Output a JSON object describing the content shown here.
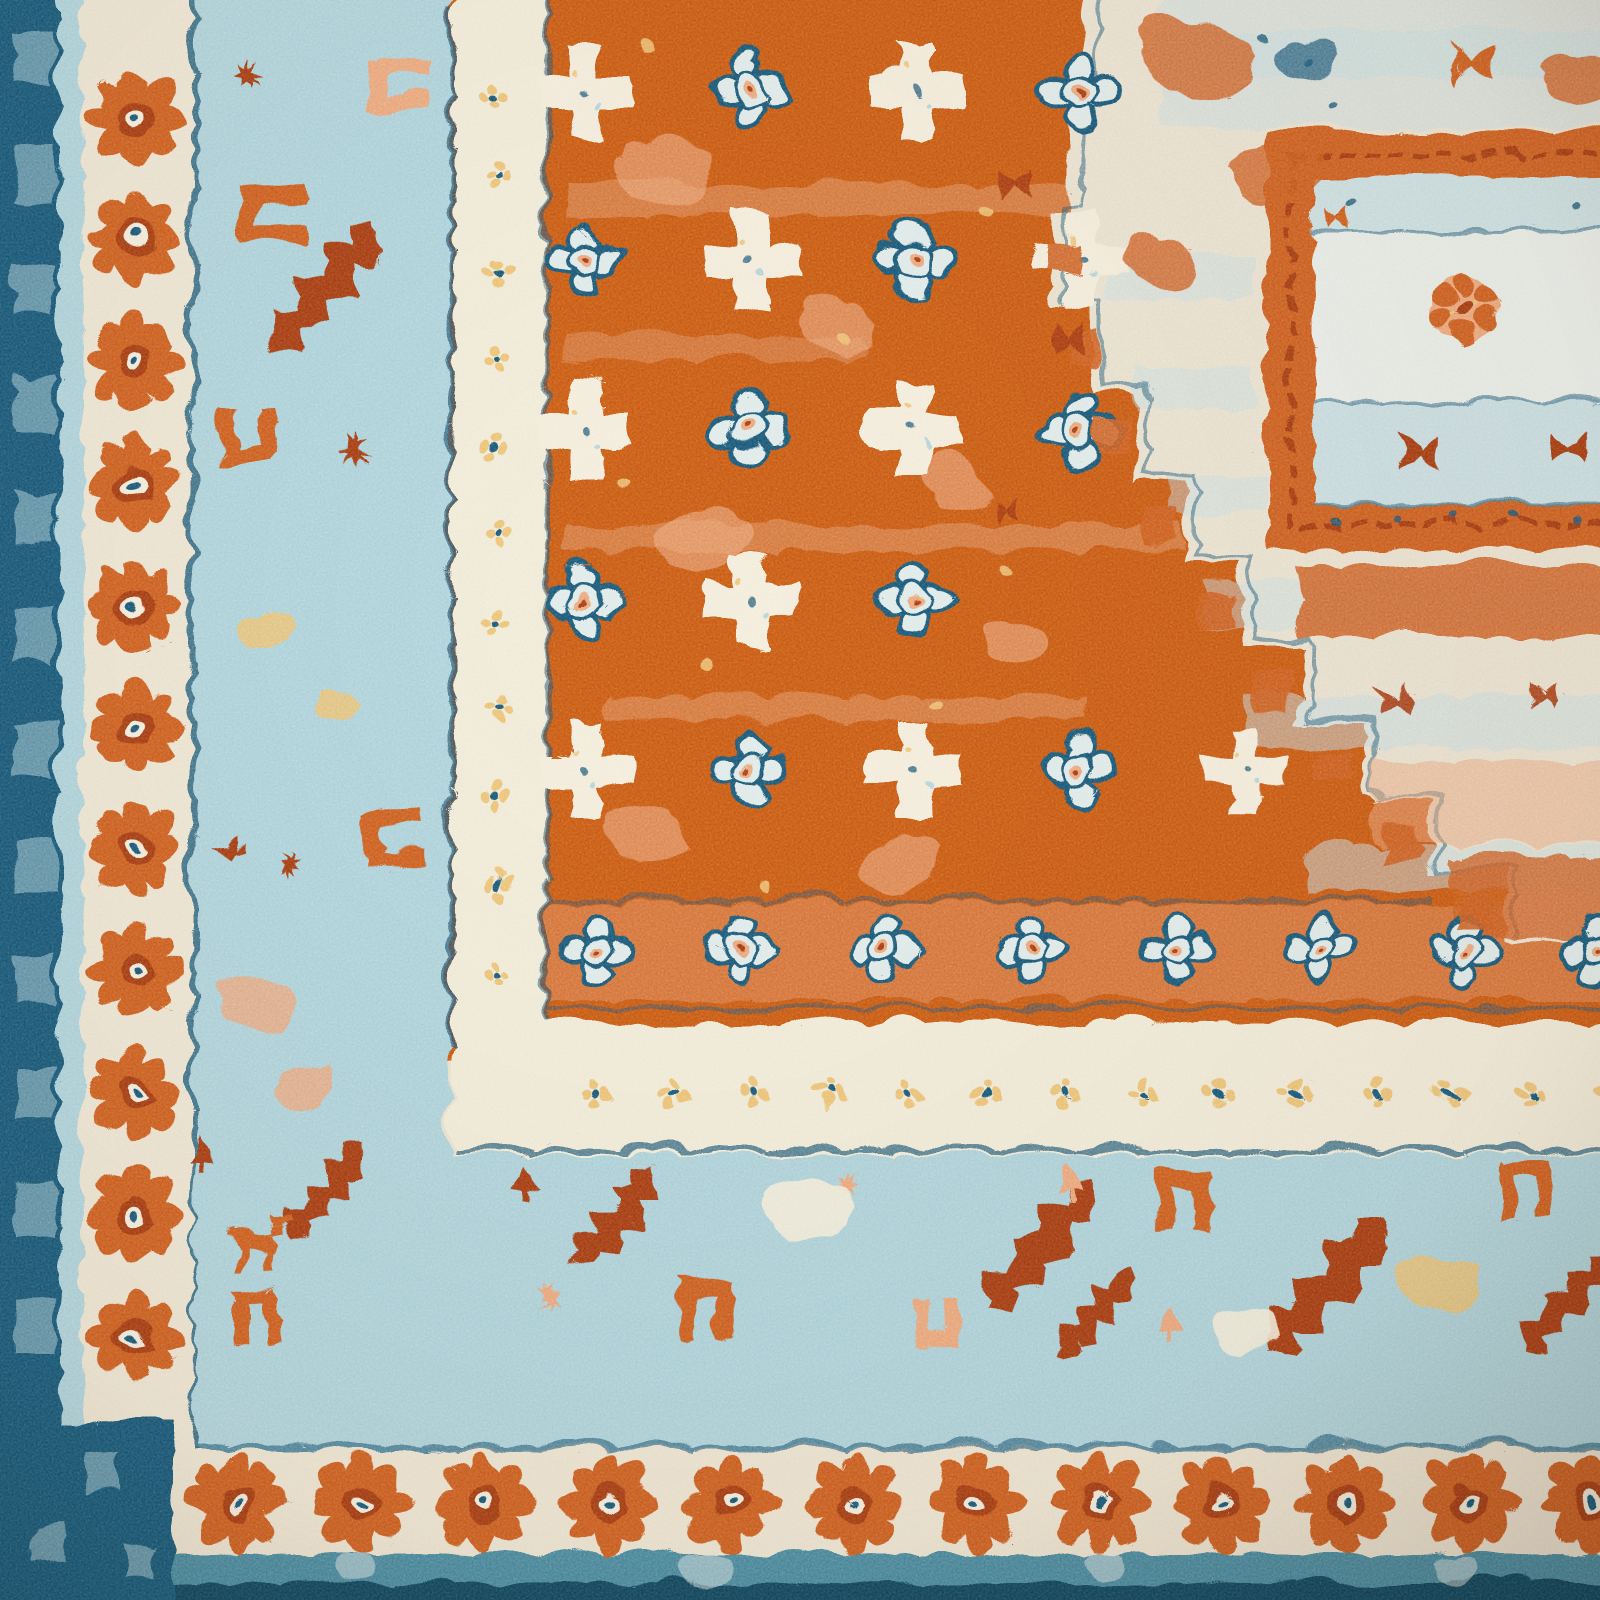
{
  "scene": {
    "type": "photograph",
    "subject": "Close-up corner of an oriental area rug",
    "description": "Top-down close-up photograph of the corner of a vintage-style oriental rug with a burnt-orange field of cream crosses and light-blue quatrefoil rosettes, a cream corner medallion panel at the upper right, a wide light-blue geometric border with rust zigzag and bracket motifs, a cream border of orange daisy rosettes, and navy edge stripes along the left and bottom.",
    "material": "tufted pile, distressed finish"
  },
  "palette": {
    "navy": "#1c5878",
    "navy_deep": "#15465f",
    "teal": "#4b8ba0",
    "lblue": "#aed2da",
    "lblue2": "#c6dde2",
    "ice": "#dfeae8",
    "cream": "#ece4d1",
    "cream2": "#f3ecdb",
    "guard": "#f0ead7",
    "panel": "#e8ece7",
    "med_cream": "#e9e1cf",
    "field": "#c95a18",
    "orange": "#cd5f22",
    "rust": "#a63c14",
    "salmon": "#eba87d",
    "peach": "#f2c6a2",
    "yellow": "#ecc377"
  },
  "regions": {
    "field": {
      "name": "main field",
      "color_key": "field",
      "motifs": "cream plus-crosses, light-blue quatrefoil rosettes, salmon patches, yellow flecks"
    },
    "medallion": {
      "name": "corner medallion",
      "color_key": "med_cream",
      "motifs": "stepped diagonal edge, rust X motifs, orange-framed inner panel with floret clusters"
    },
    "left_border": {
      "bands": [
        "navy checkered edge",
        "light blue strip",
        "cream rosette border",
        "light blue geometric border",
        "cream guard border with yellow dot flowers"
      ]
    },
    "bottom_border": {
      "bands": [
        "cream guard border with yellow dot flowers",
        "light blue geometric border",
        "cream rosette border",
        "teal strip",
        "navy edge"
      ]
    }
  },
  "motif_layers": [
    {
      "name": "field-blobs",
      "symbol": "blob",
      "color": "salmon",
      "opacity": 0.6,
      "items": [
        [
          660,
          170,
          1.2,
          0
        ],
        [
          830,
          320,
          1,
          25
        ],
        [
          700,
          540,
          1.1,
          -15
        ],
        [
          950,
          480,
          0.9,
          40
        ],
        [
          640,
          830,
          1,
          10
        ],
        [
          900,
          860,
          0.9,
          -30
        ],
        [
          1010,
          640,
          0.8,
          0
        ]
      ]
    },
    {
      "name": "field-crosses",
      "symbol": "cross",
      "items": [
        [
          580,
          85
        ],
        [
          910,
          85
        ],
        [
          745,
          255
        ],
        [
          1075,
          255
        ],
        [
          580,
          425
        ],
        [
          910,
          425
        ],
        [
          745,
          595
        ],
        [
          580,
          765
        ],
        [
          910,
          765
        ],
        [
          1240,
          765,
          0.85
        ]
      ]
    },
    {
      "name": "field-quats",
      "symbol": "quat",
      "items": [
        [
          745,
          85
        ],
        [
          1075,
          85
        ],
        [
          580,
          255
        ],
        [
          910,
          255
        ],
        [
          745,
          425
        ],
        [
          1075,
          425
        ],
        [
          580,
          595
        ],
        [
          910,
          595
        ],
        [
          745,
          765
        ],
        [
          1075,
          765
        ]
      ]
    },
    {
      "name": "field-chain",
      "symbol": "quat",
      "items": [
        [
          590,
          946,
          0.92
        ],
        [
          735,
          946,
          0.92
        ],
        [
          880,
          946,
          0.92
        ],
        [
          1025,
          946,
          0.92
        ],
        [
          1170,
          946,
          0.92
        ],
        [
          1315,
          946,
          0.92
        ],
        [
          1460,
          946,
          0.92
        ],
        [
          1590,
          946,
          0.92
        ]
      ]
    },
    {
      "name": "field-specks",
      "symbol": "dot",
      "color": "yellow",
      "opacity": 0.85,
      "items": [
        [
          640,
          40,
          1.3
        ],
        [
          840,
          330,
          1.3
        ],
        [
          700,
          660,
          1.3
        ],
        [
          980,
          210,
          1.3
        ],
        [
          760,
          880,
          1.3
        ],
        [
          930,
          700,
          1.3
        ],
        [
          615,
          480,
          1.3
        ],
        [
          1005,
          565,
          1.3
        ]
      ]
    },
    {
      "name": "medallion-patches",
      "symbol": "blob",
      "color": "orange",
      "opacity": 0.8,
      "items": [
        [
          1190,
          55,
          1.4,
          10
        ],
        [
          1272,
          168,
          1.15,
          -15
        ],
        [
          1150,
          258,
          0.9,
          30
        ],
        [
          1572,
          74,
          0.9,
          0
        ]
      ]
    },
    {
      "name": "medallion-navy-patches",
      "symbol": "blob",
      "color": "navy",
      "opacity": 0.7,
      "items": [
        [
          1302,
          56,
          0.75,
          0
        ]
      ]
    },
    {
      "name": "edge-steps",
      "symbol": "sq",
      "color": "orange",
      "opacity": 0.9,
      "items": [
        [
          1056,
          255,
          1
        ],
        [
          1078,
          345,
          0.9
        ],
        [
          1108,
          430,
          1
        ],
        [
          1156,
          520,
          1.05
        ],
        [
          1210,
          605,
          1
        ],
        [
          1268,
          688,
          1.05
        ],
        [
          1330,
          765,
          1
        ],
        [
          1398,
          840,
          1.05
        ],
        [
          1470,
          905,
          1
        ]
      ]
    },
    {
      "name": "medallion-x",
      "symbol": "xmot",
      "color": "rust",
      "opacity": 0.9,
      "items": [
        [
          1008,
          178,
          0.55
        ],
        [
          1062,
          335,
          0.5
        ],
        [
          1002,
          505,
          0.45
        ],
        [
          1390,
          695,
          0.55
        ],
        [
          1540,
          688,
          0.52
        ]
      ]
    },
    {
      "name": "panel-clusters",
      "symbol": "cluster",
      "items": [
        [
          1460,
          302,
          1.25
        ],
        [
          1638,
          300,
          1.1
        ]
      ]
    },
    {
      "name": "panel-x-rust",
      "symbol": "xmot",
      "color": "rust",
      "items": [
        [
          1415,
          450,
          0.6
        ],
        [
          1562,
          443,
          0.58
        ]
      ]
    },
    {
      "name": "panel-x-orange",
      "symbol": "xmot",
      "color": "orange",
      "items": [
        [
          1332,
          212,
          0.42
        ],
        [
          1470,
          58,
          0.78
        ]
      ]
    },
    {
      "name": "panel-dots",
      "symbol": "dot",
      "color": "navy",
      "opacity": 0.8,
      "items": [
        [
          1332,
          514
        ],
        [
          1392,
          514
        ],
        [
          1452,
          514
        ],
        [
          1512,
          514
        ],
        [
          1572,
          514
        ],
        [
          1632,
          514
        ],
        [
          1348,
          198
        ],
        [
          1568,
          198
        ],
        [
          1302,
          58
        ],
        [
          1330,
          104
        ],
        [
          1258,
          30
        ]
      ]
    },
    {
      "name": "left-band-salmon-bracket",
      "symbol": "ubr",
      "color": "salmon",
      "items": [
        [
          392,
          80,
          0.85,
          90
        ]
      ]
    },
    {
      "name": "left-band-orange-brackets",
      "symbol": "ubr",
      "color": "orange",
      "items": [
        [
          268,
          208,
          0.9,
          90
        ],
        [
          243,
          432,
          0.8,
          0
        ],
        [
          390,
          835,
          0.85,
          90
        ],
        [
          250,
          1310,
          0.75,
          180
        ]
      ]
    },
    {
      "name": "left-band-zigzags",
      "symbol": "zig",
      "color": "rust",
      "items": [
        [
          320,
          285,
          1.15,
          0
        ],
        [
          320,
          1190,
          0.85,
          0
        ]
      ]
    },
    {
      "name": "left-band-stars",
      "symbol": "star8",
      "color": "rust",
      "items": [
        [
          243,
          70,
          0.55
        ],
        [
          350,
          448,
          0.5
        ],
        [
          287,
          860,
          0.38
        ]
      ]
    },
    {
      "name": "left-band-triangles",
      "symbol": "tri",
      "color": "rust",
      "items": [
        [
          225,
          845,
          0.55,
          -90
        ],
        [
          195,
          1152,
          0.55,
          0
        ]
      ]
    },
    {
      "name": "left-band-yellow-patches",
      "symbol": "blob",
      "color": "yellow",
      "opacity": 0.85,
      "items": [
        [
          258,
          628,
          0.7,
          0
        ],
        [
          332,
          702,
          0.55,
          20
        ]
      ]
    },
    {
      "name": "left-band-salmon-patches",
      "symbol": "blob",
      "color": "salmon",
      "opacity": 0.8,
      "items": [
        [
          250,
          1000,
          0.95,
          15
        ],
        [
          300,
          1085,
          0.7,
          -20
        ]
      ]
    },
    {
      "name": "left-band-animal",
      "symbol": "deer",
      "color": "orange",
      "items": [
        [
          258,
          1238,
          0.95,
          0
        ]
      ]
    },
    {
      "name": "bottom-band-zigzags",
      "symbol": "zig",
      "color": "rust",
      "items": [
        [
          612,
          1215,
          0.95,
          0
        ],
        [
          1035,
          1245,
          1.15,
          0
        ],
        [
          1090,
          1310,
          0.8,
          0
        ],
        [
          1320,
          1285,
          1.25,
          0
        ],
        [
          1560,
          1300,
          0.9,
          0
        ]
      ]
    },
    {
      "name": "bottom-band-brackets",
      "symbol": "ubr",
      "color": "orange",
      "items": [
        [
          700,
          1305,
          0.85,
          180
        ],
        [
          1180,
          1195,
          0.85,
          180
        ],
        [
          1520,
          1185,
          0.8,
          180
        ]
      ]
    },
    {
      "name": "bottom-band-salmon-bracket",
      "symbol": "ubr",
      "color": "salmon",
      "items": [
        [
          930,
          1315,
          0.7,
          0
        ]
      ]
    },
    {
      "name": "bottom-band-tri-rust",
      "symbol": "tri",
      "color": "rust",
      "items": [
        [
          520,
          1178,
          0.62,
          0
        ]
      ]
    },
    {
      "name": "bottom-band-tri-salmon",
      "symbol": "tri",
      "color": "salmon",
      "items": [
        [
          1165,
          1318,
          0.6,
          0
        ],
        [
          1065,
          1180,
          0.5,
          0
        ]
      ]
    },
    {
      "name": "bottom-band-stars",
      "symbol": "star8",
      "color": "salmon",
      "items": [
        [
          545,
          1292,
          0.45
        ],
        [
          840,
          1180,
          0.4
        ]
      ]
    },
    {
      "name": "bottom-band-yellow-patch",
      "symbol": "blob",
      "color": "yellow",
      "opacity": 0.85,
      "items": [
        [
          1437,
          1282,
          0.95,
          0
        ]
      ]
    },
    {
      "name": "bottom-band-cream-patches",
      "symbol": "blob",
      "color": "cream2",
      "opacity": 0.9,
      "items": [
        [
          800,
          1205,
          1.1,
          0
        ],
        [
          1240,
          1330,
          0.8,
          0
        ]
      ]
    },
    {
      "name": "guard-dots-vertical",
      "symbol": "dotf",
      "items": [
        [
          493,
          90
        ],
        [
          493,
          178
        ],
        [
          493,
          266
        ],
        [
          493,
          354
        ],
        [
          493,
          442
        ],
        [
          493,
          530
        ],
        [
          493,
          618
        ],
        [
          493,
          706
        ],
        [
          493,
          794
        ],
        [
          493,
          882
        ],
        [
          493,
          970
        ]
      ]
    },
    {
      "name": "guard-dots-horizontal",
      "symbol": "dotf",
      "items": [
        [
          590,
          1088
        ],
        [
          668,
          1088
        ],
        [
          746,
          1088
        ],
        [
          824,
          1088
        ],
        [
          902,
          1088
        ],
        [
          980,
          1088
        ],
        [
          1058,
          1088
        ],
        [
          1136,
          1088
        ],
        [
          1214,
          1088
        ],
        [
          1292,
          1088
        ],
        [
          1370,
          1088
        ],
        [
          1448,
          1088
        ],
        [
          1526,
          1088
        ],
        [
          1604,
          1088
        ]
      ]
    },
    {
      "name": "left-rosettes",
      "symbol": "rosette",
      "items": [
        [
          130,
          112
        ],
        [
          130,
          234
        ],
        [
          130,
          356
        ],
        [
          130,
          478
        ],
        [
          130,
          600
        ],
        [
          130,
          722
        ],
        [
          130,
          844
        ],
        [
          130,
          966
        ],
        [
          130,
          1088
        ],
        [
          130,
          1210
        ],
        [
          130,
          1332
        ]
      ]
    },
    {
      "name": "bottom-rosettes",
      "symbol": "rosette",
      "items": [
        [
          233,
          1498,
          1.05
        ],
        [
          356,
          1498,
          1.05
        ],
        [
          479,
          1498,
          1.05
        ],
        [
          602,
          1498,
          1.05
        ],
        [
          725,
          1498,
          1.05
        ],
        [
          848,
          1498,
          1.05
        ],
        [
          971,
          1498,
          1.05
        ],
        [
          1094,
          1498,
          1.05
        ],
        [
          1217,
          1498,
          1.05
        ],
        [
          1340,
          1498,
          1.05
        ],
        [
          1463,
          1498,
          1.05
        ],
        [
          1586,
          1498,
          1.05
        ]
      ]
    },
    {
      "name": "navy-edge-checks",
      "symbol": "chk",
      "items": [
        [
          30,
          55
        ],
        [
          30,
          170
        ],
        [
          30,
          285
        ],
        [
          30,
          400
        ],
        [
          30,
          515
        ],
        [
          30,
          630
        ],
        [
          30,
          745
        ],
        [
          30,
          860
        ],
        [
          30,
          975
        ],
        [
          30,
          1090
        ],
        [
          30,
          1205
        ],
        [
          30,
          1320
        ],
        [
          95,
          1468,
          0.8
        ],
        [
          45,
          1540,
          0.7
        ],
        [
          135,
          1556,
          0.6
        ]
      ]
    },
    {
      "name": "teal-speckles",
      "symbol": "blob",
      "color": "ice",
      "opacity": 0.5,
      "items": [
        [
          700,
          1565,
          0.6,
          0
        ],
        [
          1100,
          1560,
          0.5,
          0
        ],
        [
          1450,
          1568,
          0.55,
          0
        ],
        [
          350,
          1562,
          0.5,
          0
        ]
      ]
    }
  ]
}
